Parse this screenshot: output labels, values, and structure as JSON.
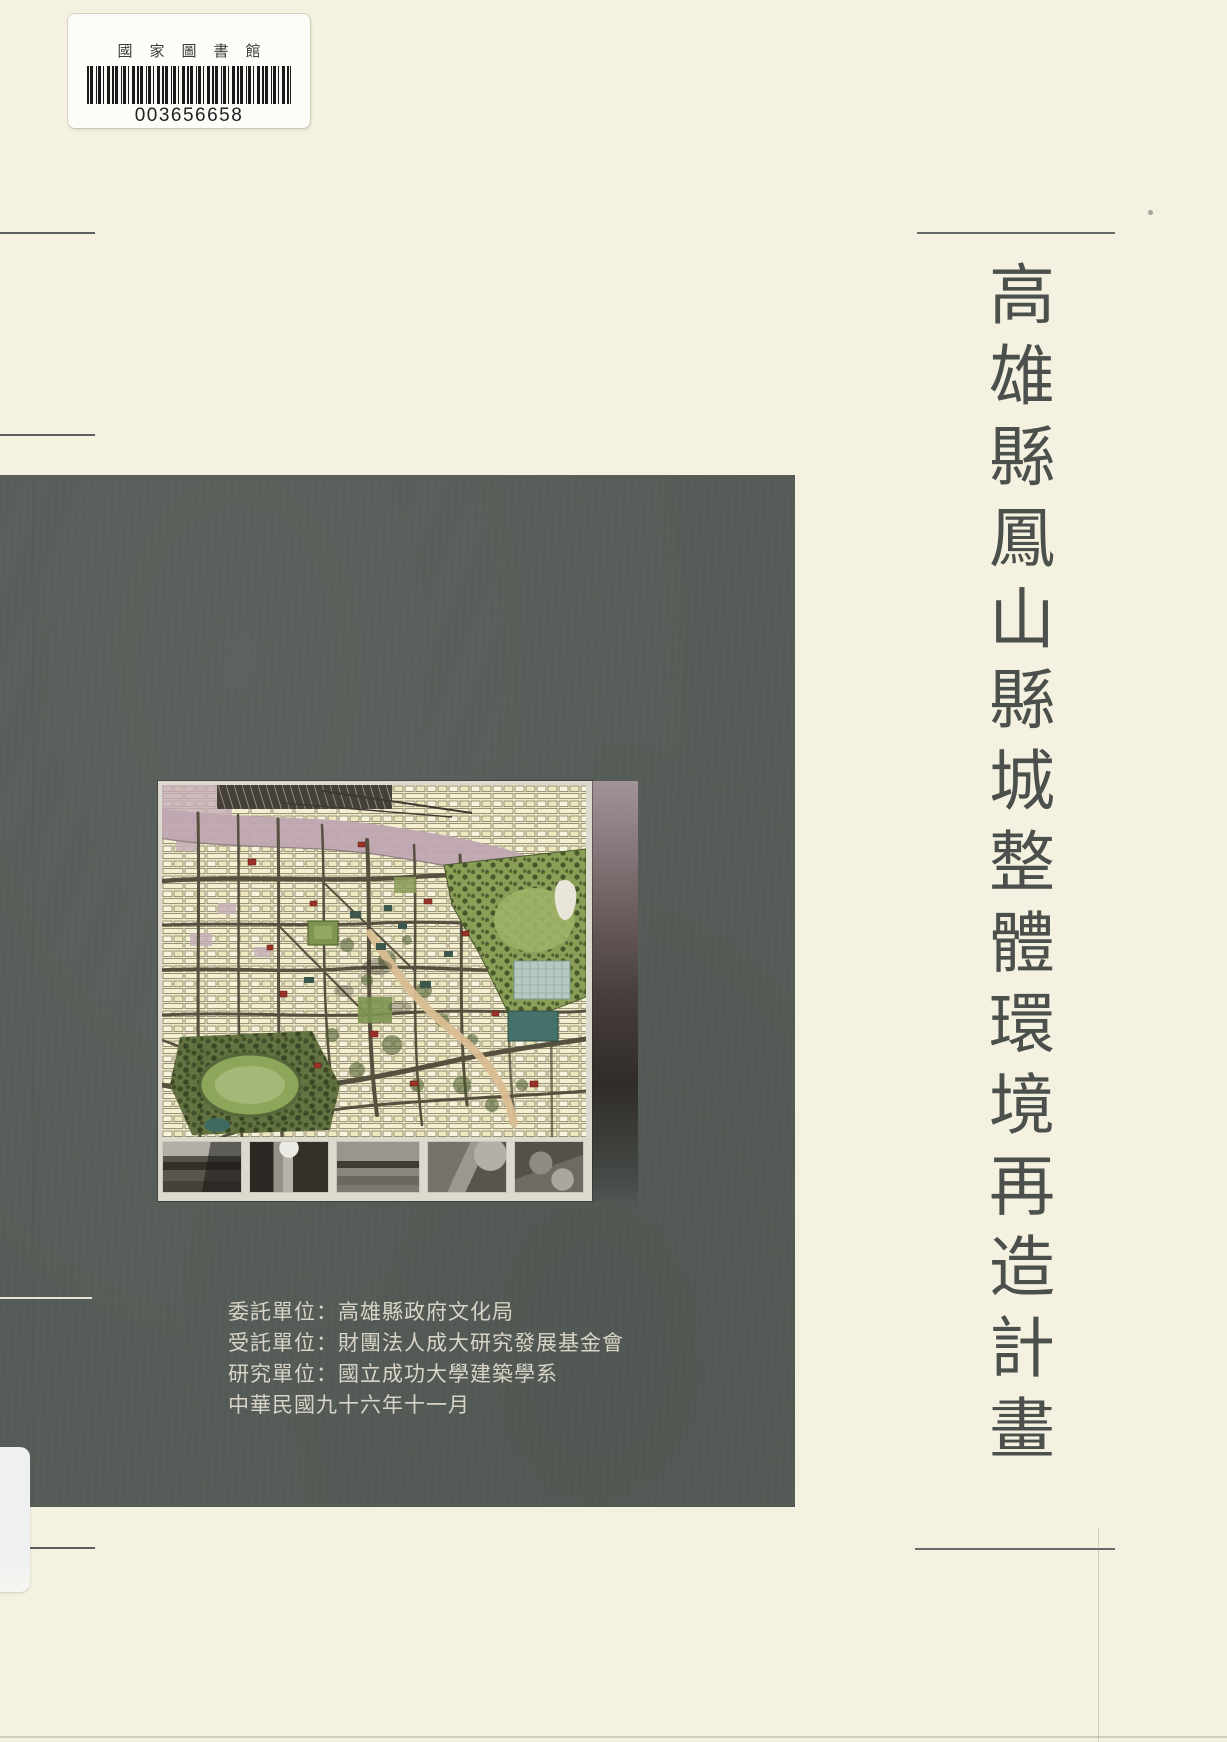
{
  "colors": {
    "page_background": "#f4f1e0",
    "panel": "#575d58",
    "title_text": "#4b504d",
    "credits_text": "#d8d5c8"
  },
  "library_label": {
    "institution": "國家圖書館",
    "barcode_number": "003656658"
  },
  "title": {
    "vertical_text": "高雄縣鳳山縣城整體環境再造計畫"
  },
  "credits": {
    "lines": [
      "委託單位：高雄縣政府文化局",
      "受託單位：財團法人成大研究發展基金會",
      "研究單位：國立成功大學建築學系",
      "中華民國九十六年十一月"
    ]
  },
  "figure": {
    "type": "urban-master-plan-map",
    "photo_count": 5
  }
}
